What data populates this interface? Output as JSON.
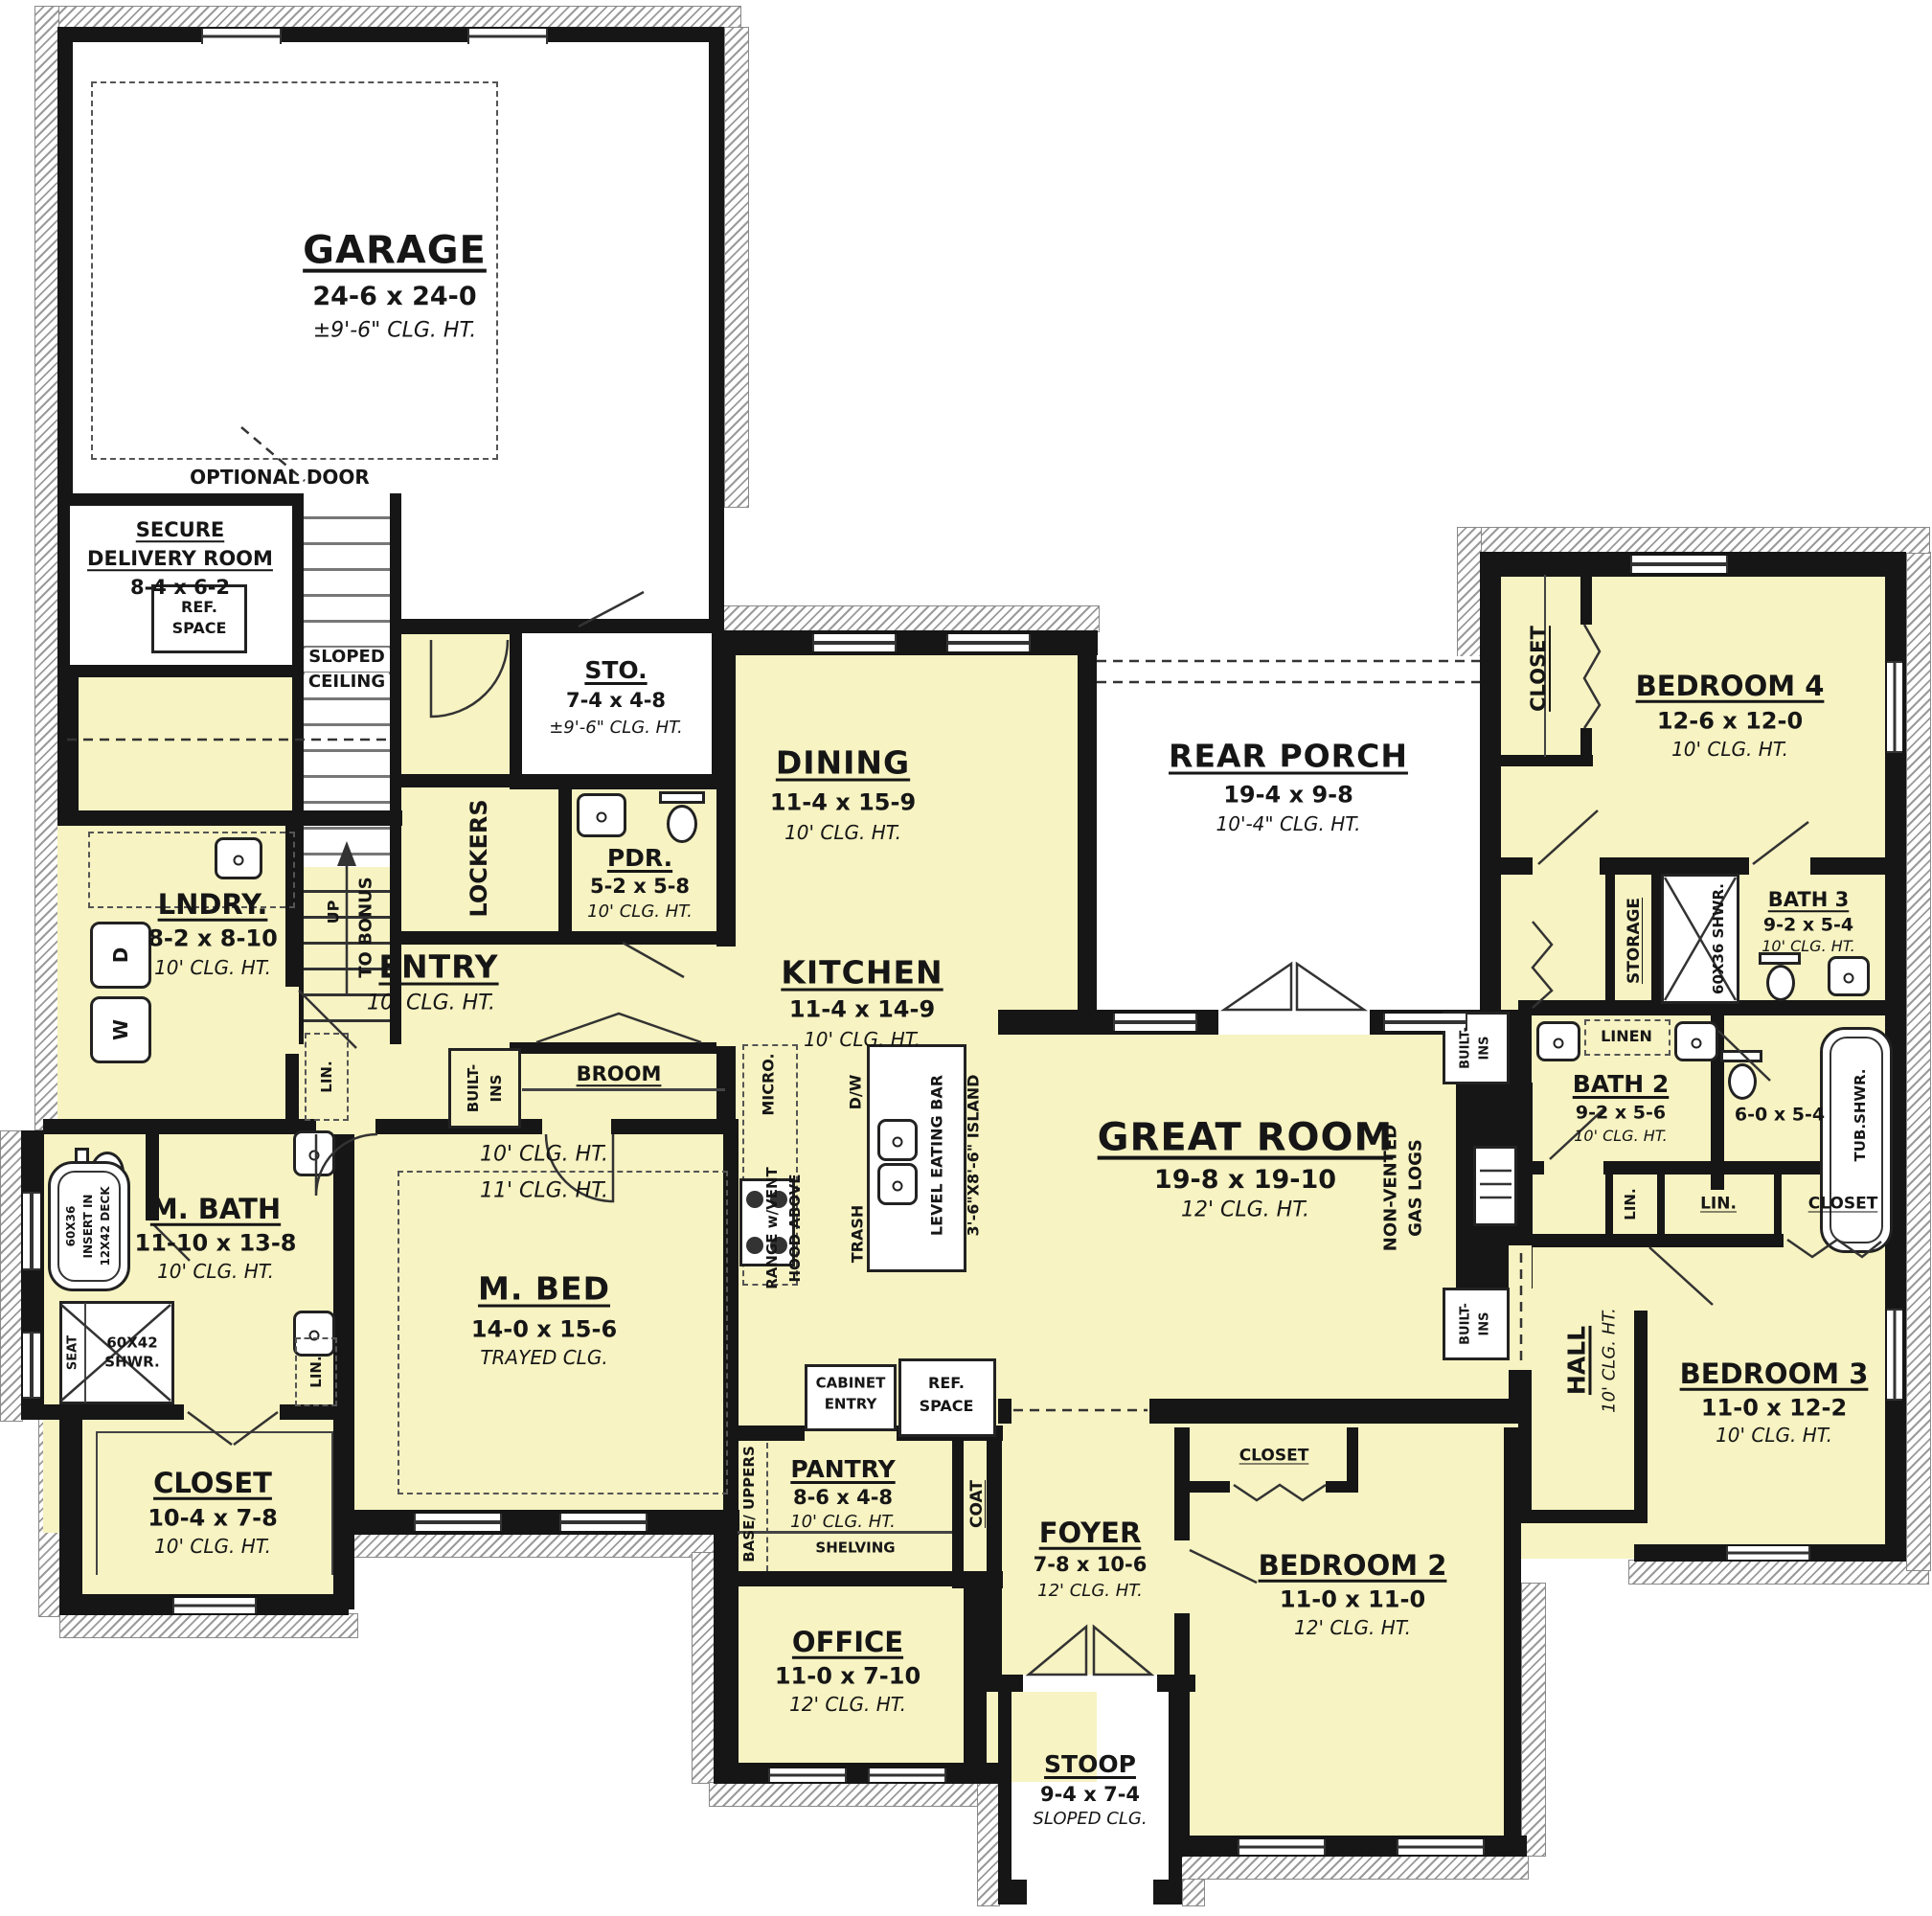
{
  "colors": {
    "floor": "#F7F3C2",
    "wall": "#161616",
    "outside": "#FFFFFF",
    "hatch": "#9A9A9A"
  },
  "rooms": {
    "garage": {
      "name": "GARAGE",
      "dims": "24-6 x 24-0",
      "clg": "±9'-6\" CLG. HT."
    },
    "secure_delivery": {
      "line1": "SECURE",
      "line2": "DELIVERY ROOM",
      "dims": "8-4 x 6-2"
    },
    "sto": {
      "name": "STO.",
      "dims": "7-4 x 4-8",
      "clg": "±9'-6\" CLG. HT."
    },
    "pdr": {
      "name": "PDR.",
      "dims": "5-2 x 5-8",
      "clg": "10' CLG. HT."
    },
    "entry": {
      "name": "ENTRY",
      "clg": "10' CLG. HT."
    },
    "lndry": {
      "name": "LNDRY.",
      "dims": "8-2 x 8-10",
      "clg": "10' CLG. HT."
    },
    "dining": {
      "name": "DINING",
      "dims": "11-4 x 15-9",
      "clg": "10' CLG. HT."
    },
    "rear_porch": {
      "name": "REAR PORCH",
      "dims": "19-4 x 9-8",
      "clg": "10'-4\" CLG. HT."
    },
    "kitchen": {
      "name": "KITCHEN",
      "dims": "11-4 x 14-9",
      "clg": "10' CLG. HT."
    },
    "great_room": {
      "name": "GREAT ROOM",
      "dims": "19-8 x 19-10",
      "clg": "12' CLG. HT."
    },
    "m_bath": {
      "name": "M. BATH",
      "dims": "11-10 x 13-8",
      "clg": "10' CLG. HT."
    },
    "m_bed": {
      "name": "M. BED",
      "dims": "14-0 x 15-6",
      "clg": "TRAYED CLG.",
      "tray10": "10' CLG. HT.",
      "tray11": "11' CLG. HT."
    },
    "m_closet": {
      "name": "CLOSET",
      "dims": "10-4 x 7-8",
      "clg": "10' CLG. HT."
    },
    "pantry": {
      "name": "PANTRY",
      "dims": "8-6 x 4-8",
      "clg": "10' CLG. HT.",
      "shelving": "SHELVING"
    },
    "office": {
      "name": "OFFICE",
      "dims": "11-0 x 7-10",
      "clg": "12' CLG. HT."
    },
    "foyer": {
      "name": "FOYER",
      "dims": "7-8 x 10-6",
      "clg": "12' CLG. HT."
    },
    "stoop": {
      "name": "STOOP",
      "dims": "9-4 x 7-4",
      "clg": "SLOPED CLG."
    },
    "bed2": {
      "name": "BEDROOM 2",
      "dims": "11-0 x 11-0",
      "clg": "12' CLG. HT."
    },
    "bed3": {
      "name": "BEDROOM 3",
      "dims": "11-0 x 12-2",
      "clg": "10' CLG. HT."
    },
    "bed4": {
      "name": "BEDROOM 4",
      "dims": "12-6 x 12-0",
      "clg": "10' CLG. HT."
    },
    "bath2": {
      "name": "BATH 2",
      "dims": "9-2 x 5-6",
      "clg": "10' CLG. HT."
    },
    "bath3": {
      "name": "BATH 3",
      "dims": "9-2 x 5-4",
      "clg": "10' CLG. HT."
    },
    "tub_room": {
      "dims": "6-0 x 5-4"
    },
    "hall": {
      "name": "HALL",
      "clg": "10' CLG. HT."
    }
  },
  "labels": {
    "optional_door": "OPTIONAL DOOR",
    "sloped1": "SLOPED",
    "sloped2": "CEILING",
    "ref1": "REF.",
    "ref2": "SPACE",
    "lockers": "LOCKERS",
    "broom": "BROOM",
    "built1": "BUILT-",
    "built2": "INS",
    "lin": "LIN.",
    "linen": "LINEN",
    "closet": "CLOSET",
    "storage": "STORAGE",
    "coat": "COAT",
    "up": "UP",
    "to_bonus": "TO BONUS",
    "washer": "W",
    "dryer": "D",
    "seat": "SEAT",
    "shwr6042a": "60X42",
    "shwr6042b": "SHWR.",
    "shwr6036": "60X36 SHWR.",
    "tub1": "60X36",
    "tub2": "INSERT IN",
    "tub3": "12X42 DECK",
    "tub_shwr": "TUB.SHWR.",
    "micro": "MICRO.",
    "dw": "D/W",
    "trash": "TRASH",
    "eating_bar": "LEVEL EATING BAR",
    "island": "3'-6\"X8'-6\" ISLAND",
    "range1": "RANGE w/VENT",
    "range2": "HOOD ABOVE",
    "cabinet1": "CABINET",
    "cabinet2": "ENTRY",
    "gas1": "NON-VENTED",
    "gas2": "GAS LOGS",
    "base_uppers": "BASE/ UPPERS"
  }
}
